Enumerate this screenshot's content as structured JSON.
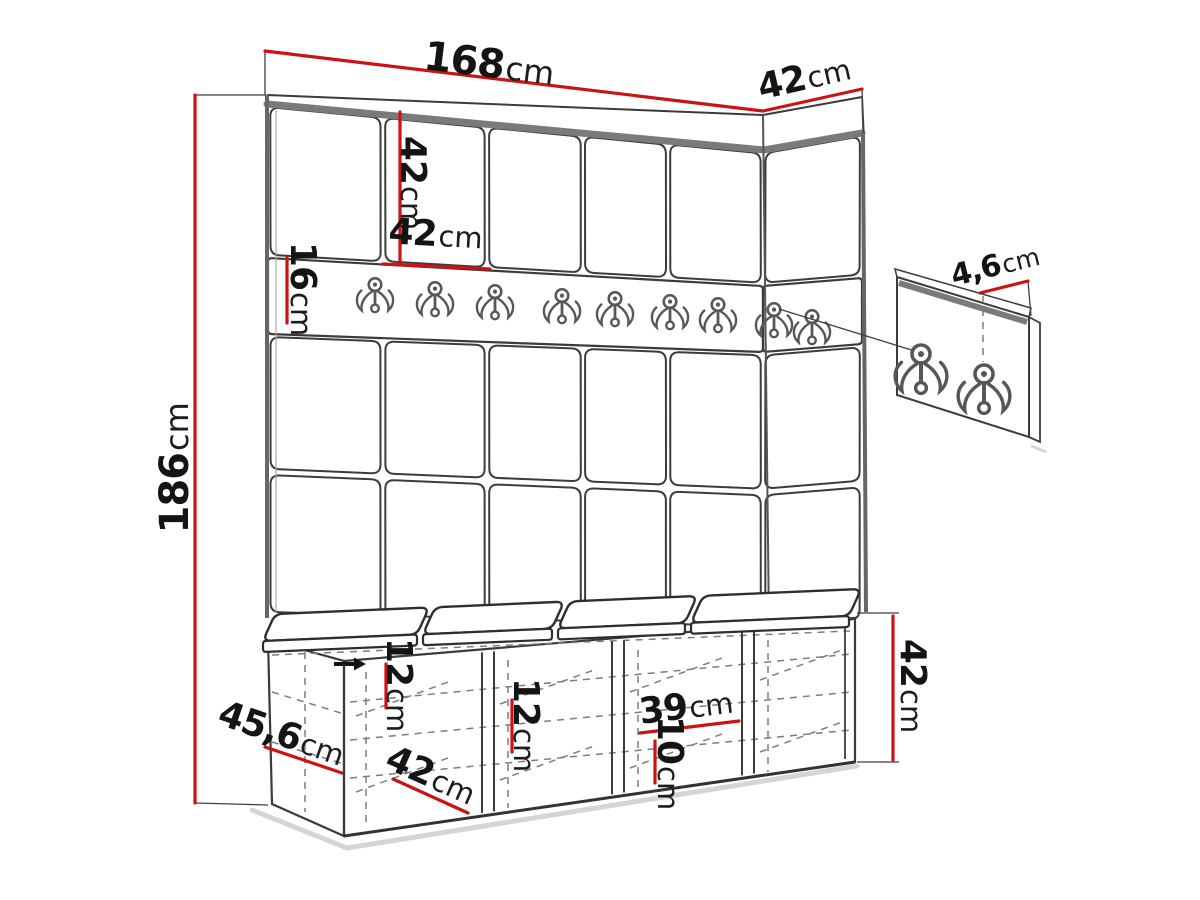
{
  "diagram": {
    "kind": "hallway furniture set dimension drawing",
    "parts": [
      "wall panel unit with coat hooks",
      "corner side panel",
      "hook detail panel",
      "shoe bench with cushions"
    ]
  },
  "dimensions": {
    "total_width": {
      "value": "168",
      "unit": "cm"
    },
    "side_panel_width": {
      "value": "42",
      "unit": "cm"
    },
    "panel_height": {
      "value": "42",
      "unit": "cm"
    },
    "panel_width": {
      "value": "42",
      "unit": "cm"
    },
    "hook_rail_height": {
      "value": "16",
      "unit": "cm"
    },
    "total_height": {
      "value": "186",
      "unit": "cm"
    },
    "hook_detail_spacing": {
      "value": "4,6",
      "unit": "cm"
    },
    "bench_shelf_gap_left": {
      "value": "12",
      "unit": "cm"
    },
    "bench_shelf_gap_middle": {
      "value": "12",
      "unit": "cm"
    },
    "bench_inner_width": {
      "value": "39",
      "unit": "cm"
    },
    "bench_shelf_gap_right": {
      "value": "10",
      "unit": "cm"
    },
    "bench_height": {
      "value": "42",
      "unit": "cm"
    },
    "bench_depth": {
      "value": "45,6",
      "unit": "cm"
    },
    "bench_compartment_width": {
      "value": "42",
      "unit": "cm"
    }
  },
  "counts": {
    "wall_hooks": 9,
    "detail_panel_hooks": 2,
    "bench_compartments": 4,
    "bench_cushions": 4,
    "wall_panel_columns_front": 5,
    "wall_panel_columns_side": 1,
    "wall_panel_rows": 3
  },
  "colors": {
    "dimension_line": "#cc1212",
    "outline_ink": "#3b3b3b",
    "trim_gray": "#7a7a7a",
    "background": "#ffffff"
  }
}
